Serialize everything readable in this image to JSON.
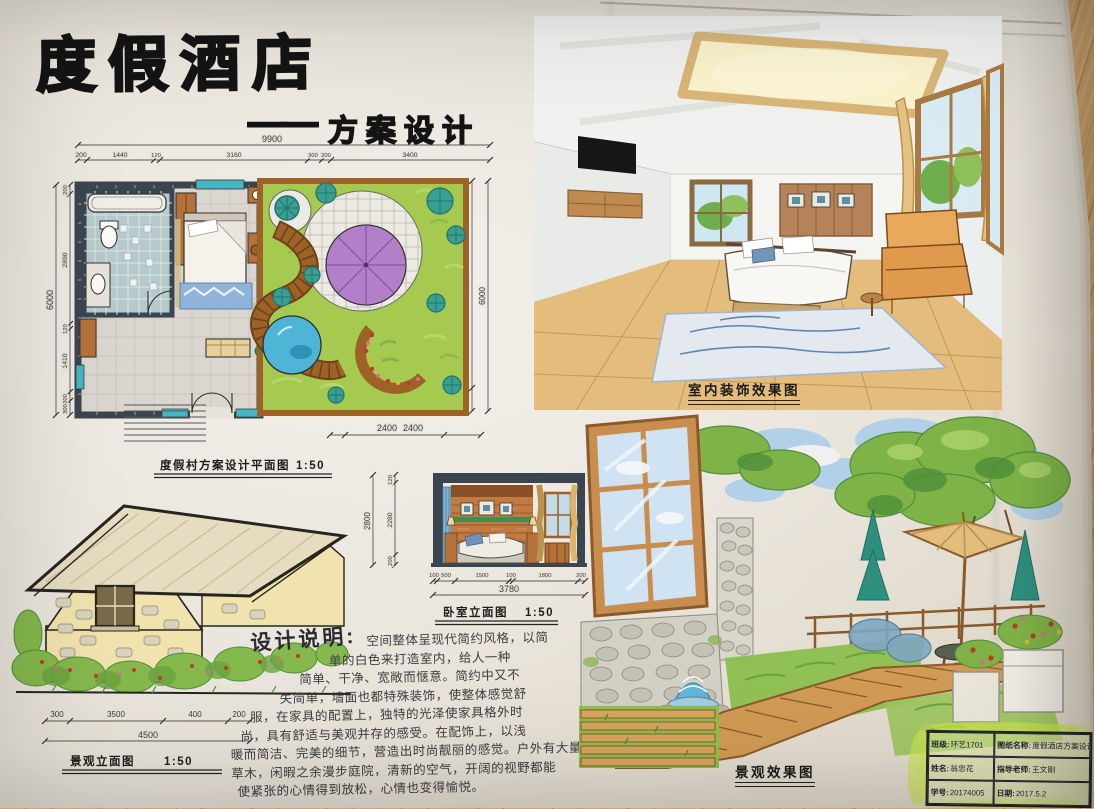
{
  "title": {
    "main": "度假酒店",
    "dash": "——",
    "subtitle": "方案设计"
  },
  "plan": {
    "caption": "度假村方案设计平面图",
    "scale": "1:50",
    "dim_total_top": "9900",
    "top_segments": [
      "200",
      "1440",
      "120",
      "3160",
      "300",
      "200",
      "3400"
    ],
    "dim_total_left": "6000",
    "left_segments": [
      "200",
      "2890",
      "120",
      "1410",
      "200",
      "300"
    ],
    "right_segments": [
      "5200",
      "600"
    ],
    "dim_total_right": "6000",
    "dim_courtyard": "2400"
  },
  "elevation": {
    "caption": "景观立面图",
    "scale": "1:50",
    "segments": [
      "300",
      "3500",
      "400",
      "200"
    ],
    "total": "4500"
  },
  "section": {
    "caption": "卧室立面图",
    "scale": "1:50",
    "dim_top": "2400",
    "left_total": "2800",
    "left_segments": [
      "120",
      "2280",
      "200"
    ],
    "bottom_segments": [
      "100",
      "500",
      "1500",
      "100",
      "1800",
      "200"
    ],
    "bottom_total": "3780"
  },
  "notes": {
    "heading": "设计说明:",
    "lines": [
      "空间整体呈现代简约风格，以简",
      "单的白色来打造室内，给人一种",
      "简单、干净、宽敞而惬意。简约中又不",
      "失简单，墙面也都特殊装饰，使整体感觉舒",
      "服，在家具的配置上，独特的光泽使家具格外时",
      "尚，具有舒适与美观并存的感受。在配饰上，以浅",
      "暖而简洁、完美的细节，营造出时尚靓丽的感觉。户外有大量",
      "草木，闲暇之余漫步庭院，清新的空气，开阔的视野都能",
      "使紧张的心情得到放松，心情也变得愉悦。"
    ]
  },
  "interior": {
    "caption": "室内装饰效果图"
  },
  "landscape": {
    "caption": "景观效果图"
  },
  "titleblock": {
    "rows": [
      {
        "l_label": "班级:",
        "l_value": "环艺1701",
        "r_label": "图纸名称:",
        "r_value": "度假酒店方案设计"
      },
      {
        "l_label": "姓名:",
        "l_value": "翁忠花",
        "r_label": "指导老师:",
        "r_value": "王文刚"
      },
      {
        "l_label": "学号:",
        "l_value": "20174005",
        "r_label": "日期:",
        "r_value": "2017.5.2"
      }
    ]
  },
  "colors": {
    "paper": "#e8e3d9",
    "wood_table": "#c59a63",
    "ink": "#2a2a2a",
    "marker_green": "#a6c94f",
    "teal_tree": "#3a9e92",
    "parasol_purple": "#b27fc9",
    "pond_blue": "#4fb5d6",
    "wall_dark": "#3b4550",
    "furniture_wood": "#b4713a",
    "highlighter": "#c9e24b",
    "curtain_tan": "#e2bd7c",
    "floor_wood": "#e4bd7d"
  }
}
